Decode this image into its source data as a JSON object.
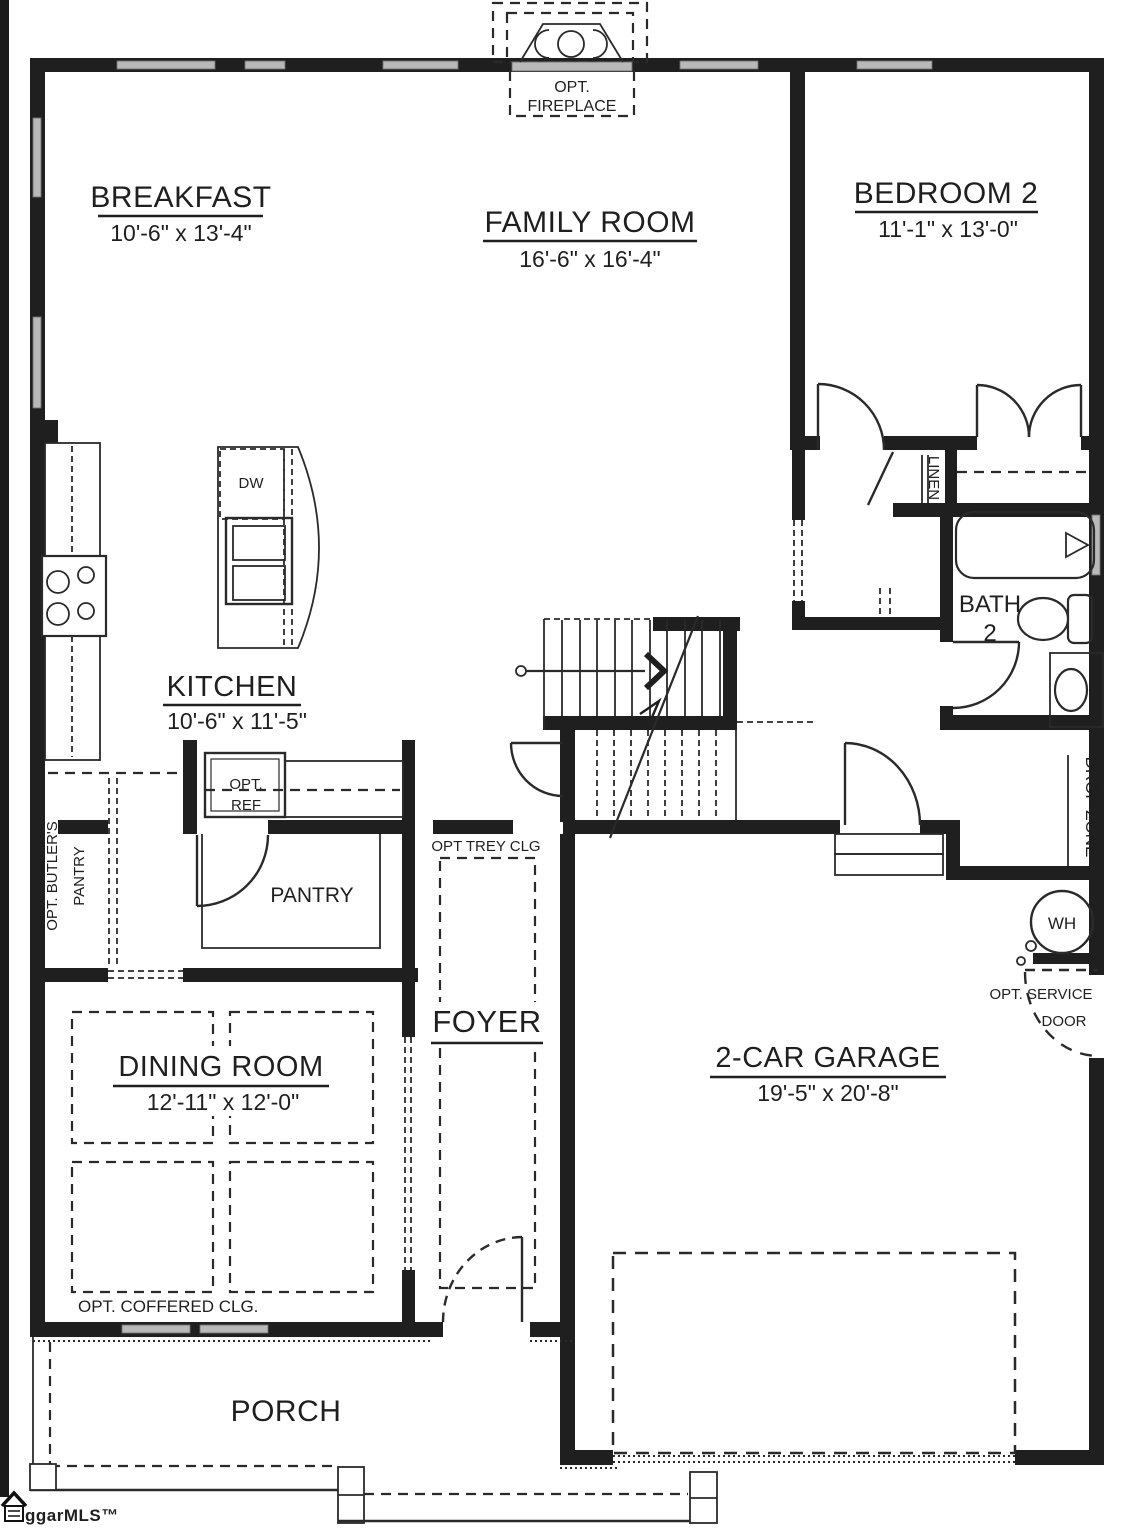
{
  "title": "First Floor Plan",
  "colors": {
    "wall": "#1f1f1f",
    "window_gray": "#b9b9b9",
    "background": "#ffffff"
  },
  "rooms": {
    "breakfast": {
      "name": "BREAKFAST",
      "dims": "10'-6\" x 13'-4\""
    },
    "family_room": {
      "name": "FAMILY ROOM",
      "dims": "16'-6\" x 16'-4\""
    },
    "bedroom2": {
      "name": "BEDROOM 2",
      "dims": "11'-1\" x 13'-0\""
    },
    "kitchen": {
      "name": "KITCHEN",
      "dims": "10'-6\" x 11'-5\""
    },
    "dining_room": {
      "name": "DINING ROOM",
      "dims": "12'-11\" x 12'-0\""
    },
    "garage": {
      "name": "2-CAR GARAGE",
      "dims": "19'-5\" x 20'-8\""
    },
    "foyer": {
      "name": "FOYER"
    },
    "porch": {
      "name": "PORCH"
    },
    "bath2": {
      "line1": "BATH",
      "line2": "2"
    },
    "pantry": {
      "name": "PANTRY"
    }
  },
  "annotations": {
    "fireplace_line1": "OPT.",
    "fireplace_line2": "FIREPLACE",
    "ref_line1": "OPT.",
    "ref_line2": "REF",
    "dishwasher": "DW",
    "linen": "LINEN",
    "drop_zone": "DROP ZONE",
    "water_heater": "WH",
    "service_door_line1": "OPT. SERVICE",
    "service_door_line2": "DOOR",
    "butlers_line1": "OPT. BUTLER'S",
    "butlers_line2": "PANTRY",
    "trey_ceiling": "OPT TREY CLG",
    "coffered_ceiling": "OPT. COFFERED CLG."
  },
  "logo": {
    "text": "ggarMLS™"
  }
}
